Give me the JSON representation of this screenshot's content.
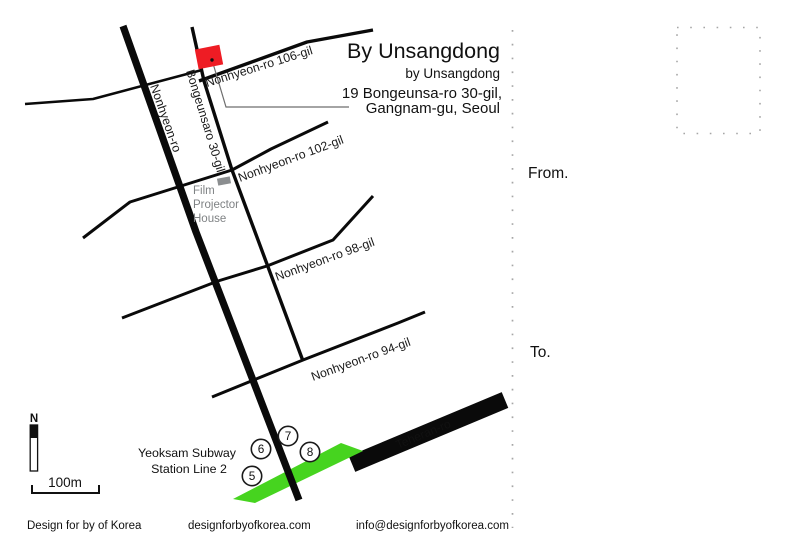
{
  "header": {
    "title": "By Unsangdong",
    "subtitle": "by Unsangdong",
    "address_line1": "19 Bongeunsa-ro 30-gil,",
    "address_line2": "Gangnam-gu, Seoul"
  },
  "map": {
    "road_labels": {
      "nonhyeon_ro": "Nonhyeon-ro",
      "bongeunsaro_30gil": "Bongeunsaro 30-gil",
      "nonhyeon_106gil": "Nonhyeon-ro 106-gil",
      "nonhyeon_102gil": "Nonhyeon-ro 102-gil",
      "nonhyeon_98gil": "Nonhyeon-ro 98-gil",
      "nonhyeon_94gil": "Nonhyeon-ro 94-gil",
      "teheran_ro": "Teheran-ro"
    },
    "poi": {
      "film_house_line1": "Film",
      "film_house_line2": "Projector",
      "film_house_line3": "House"
    },
    "subway": {
      "station_line1": "Yeoksam Subway",
      "station_line2": "Station Line 2",
      "exit5": "5",
      "exit6": "6",
      "exit7": "7",
      "exit8": "8"
    },
    "north_label": "N",
    "scale_label": "100m",
    "colors": {
      "building": "#ee1c24",
      "subway_line": "#46d41f",
      "road": "#0a0a0a",
      "poi_marker": "#8b8e90",
      "poi_text": "#7f8284",
      "dots": "#a6a6a6"
    }
  },
  "postcard": {
    "from_label": "From.",
    "to_label": "To."
  },
  "footer": {
    "credit": "Design for by of Korea",
    "website": "designforbyofkorea.com",
    "email": "info@designforbyofkorea.com"
  }
}
